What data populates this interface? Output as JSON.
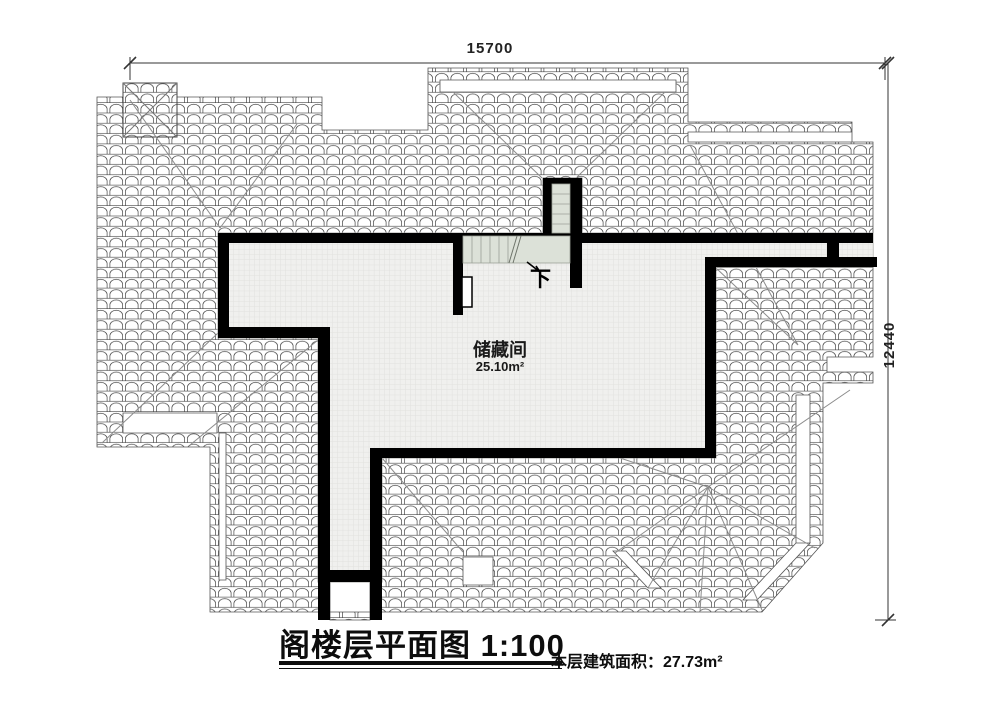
{
  "drawing": {
    "title": "阁楼层平面图 1:100",
    "footer_area_label": "本层建筑面积：27.73m²",
    "room": {
      "name": "储藏间",
      "area": "25.10m²"
    },
    "stairs": {
      "down_label": "下"
    },
    "dimensions": {
      "width": "15700",
      "height": "12440"
    },
    "colors": {
      "wall": "#000000",
      "tile_stroke": "#454545",
      "floor_bg": "#f0f0ee",
      "floor_grid": "#e1e1de",
      "stair_fill": "#dce1d8",
      "hip_line": "#8c8c8c",
      "dimension_line": "#333333"
    }
  }
}
